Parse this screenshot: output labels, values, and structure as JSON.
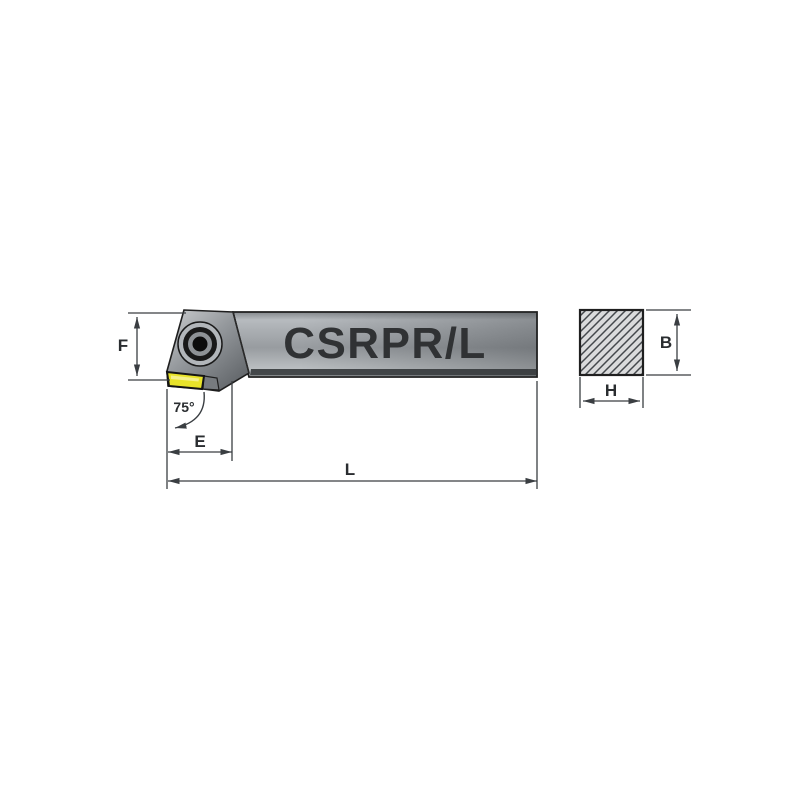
{
  "drawing": {
    "part_label": "CSRPR/L",
    "main_view": {
      "height_label": "F",
      "head_length_label": "E",
      "overall_length_label": "L",
      "approach_angle_label": "75°"
    },
    "section_view": {
      "height_label": "B",
      "width_label": "H"
    }
  },
  "colors": {
    "insert_yellow": "#e8e32a",
    "dimension_line": "#3a3e42",
    "metal_light": "#c6cacd",
    "metal_dark": "#5d6165",
    "background": "#ffffff"
  }
}
